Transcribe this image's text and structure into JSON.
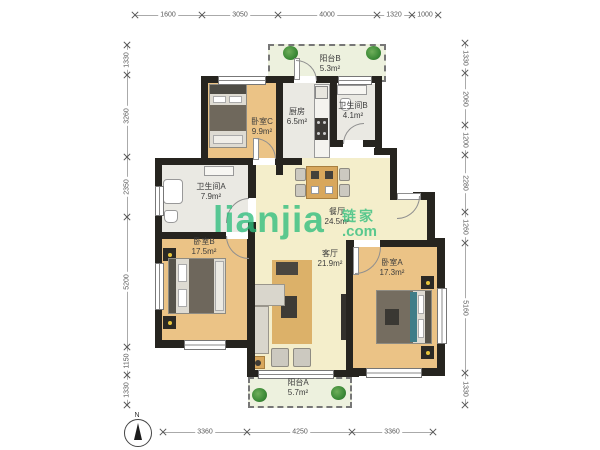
{
  "watermark": {
    "brand": "lianjia",
    "cjk": "链家",
    "tld": ".com"
  },
  "compass": {
    "label": "N"
  },
  "dimensions": {
    "top": [
      "1600",
      "3050",
      "4000",
      "1320",
      "1000"
    ],
    "bottom": [
      "3360",
      "4250",
      "3360"
    ],
    "left": [
      "1330",
      "3260",
      "2350",
      "5200",
      "1150",
      "1330"
    ],
    "right": [
      "1330",
      "2060",
      "1200",
      "2280",
      "1260",
      "5160",
      "1330"
    ]
  },
  "rooms": {
    "balcony_b": {
      "name": "阳台B",
      "area": "5.3m²"
    },
    "bedroom_c": {
      "name": "卧室C",
      "area": "9.9m²"
    },
    "kitchen": {
      "name": "厨房",
      "area": "6.5m²"
    },
    "bath_b": {
      "name": "卫生间B",
      "area": "4.1m²"
    },
    "bath_a": {
      "name": "卫生间A",
      "area": "7.9m²"
    },
    "dining": {
      "name": "餐厅",
      "area": "24.5m²"
    },
    "bedroom_b": {
      "name": "卧室B",
      "area": "17.5m²"
    },
    "living": {
      "name": "客厅",
      "area": "21.9m²"
    },
    "bedroom_a": {
      "name": "卧室A",
      "area": "17.3m²"
    },
    "balcony_a": {
      "name": "阳台A",
      "area": "5.7m²"
    }
  },
  "colors": {
    "wall": "#26241f",
    "bed_floor": "#ebc386",
    "live_floor": "#f4eecb",
    "wet_floor": "#eae9e3",
    "bal_floor": "#edf1de",
    "wm_green": "#2fbe7e"
  }
}
